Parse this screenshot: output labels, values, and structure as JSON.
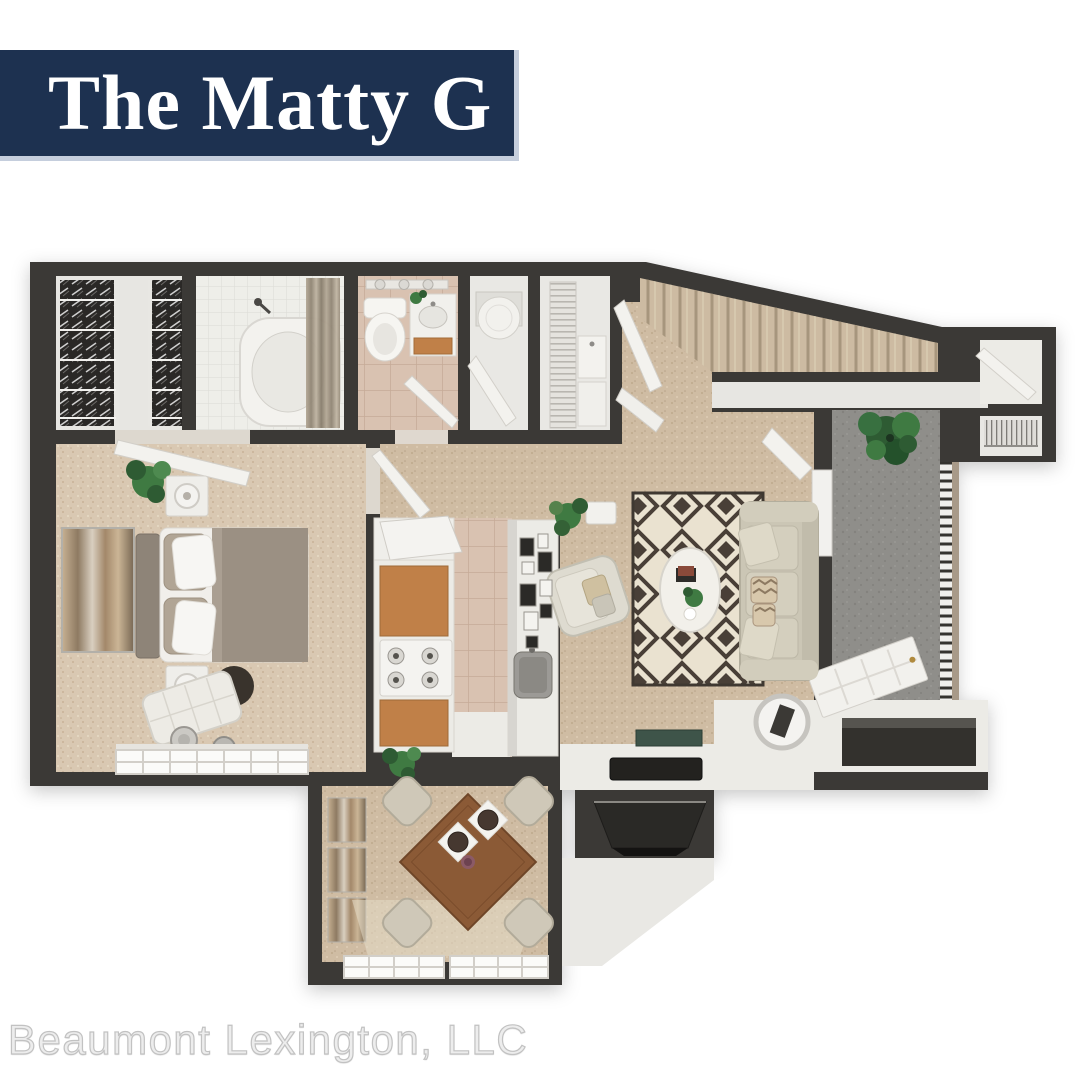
{
  "banner": {
    "title": "The Matty G"
  },
  "footer": {
    "company": "Beaumont Lexington, LLC"
  },
  "palette": {
    "page_bg": "#ffffff",
    "banner_bg": "#1d3150",
    "banner_trim": "#c5cedd",
    "banner_text": "#ffffff",
    "footer_text": "#ededed",
    "wall": "#3b3936",
    "interior": "#ecebe6",
    "carpet": "#cfbca3",
    "carpet_light": "#d9c8b2",
    "bath_tile": "#d9c2b1",
    "shower_tile": "#eeeee9",
    "concrete": "#8f8e8a",
    "rug_dark": "#493f37",
    "rug_cream": "#eae2d0",
    "cabinet_wood": "#c08048",
    "table_wood": "#8b5a36",
    "sofa": "#cbc6b5",
    "bedding": "#9b9083",
    "plant_green": "#3f7a42",
    "stairs": "#cdbba2"
  }
}
